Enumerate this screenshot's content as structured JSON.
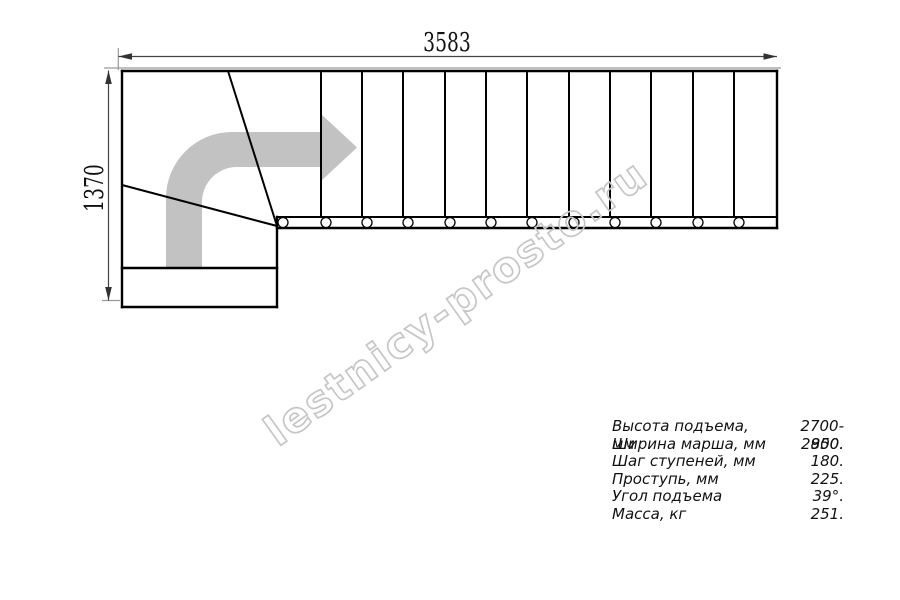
{
  "drawing": {
    "title": "staircase-plan",
    "top_dimension": "3583",
    "left_dimension": "1370",
    "direction_arrow": "turn-right-arrow",
    "step_count_straight_flight": 12,
    "colors": {
      "line": "#000000",
      "dimension_line": "#444444",
      "extension_line": "#999999",
      "arrow_fill": "#c2c2c2",
      "watermark": "#c6c6c6"
    }
  },
  "watermark": {
    "text": "lestnicy-prosto.ru"
  },
  "specs": {
    "rows": [
      {
        "label": "Высота подъема, мм",
        "value": "2700-2850."
      },
      {
        "label": "Ширина марша, мм",
        "value": "900."
      },
      {
        "label": "Шаг ступеней, мм",
        "value": "180."
      },
      {
        "label": "Проступь, мм",
        "value": "225."
      },
      {
        "label": "Угол подъема",
        "value": "39°."
      },
      {
        "label": "Масса, кг",
        "value": "251."
      }
    ]
  }
}
